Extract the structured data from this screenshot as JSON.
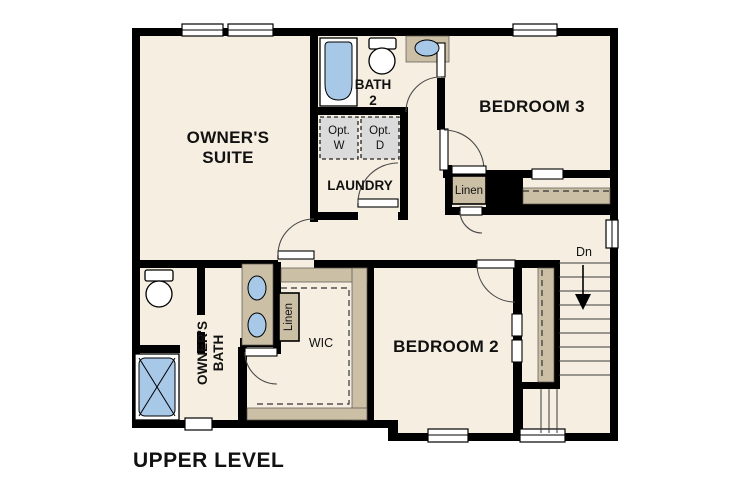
{
  "title": "UPPER LEVEL",
  "rooms": {
    "owners_suite": {
      "line1": "OWNER'S",
      "line2": "SUITE"
    },
    "bath2": {
      "line1": "BATH",
      "line2": "2"
    },
    "laundry": {
      "label": "LAUNDRY"
    },
    "bedroom3": {
      "label": "BEDROOM 3"
    },
    "bedroom2": {
      "label": "BEDROOM 2"
    },
    "owners_bath": {
      "line1": "OWNER'S",
      "line2": "BATH"
    },
    "wic": {
      "label": "WIC"
    }
  },
  "closets": {
    "hall_linen": {
      "label": "Linen"
    },
    "owners_linen": {
      "label": "Linen"
    }
  },
  "laundry_appliances": {
    "washer": {
      "line1": "Opt.",
      "line2": "W"
    },
    "dryer": {
      "line1": "Opt.",
      "line2": "D"
    }
  },
  "stairs": {
    "down_label": "Dn"
  },
  "colors": {
    "background": "#ffffff",
    "floor": "#f6efe1",
    "walls": "#000000",
    "counters": "#cbbfa5",
    "fixtures_blue": "#a8c8e8",
    "optional_appliances": "#dbdbdb"
  }
}
